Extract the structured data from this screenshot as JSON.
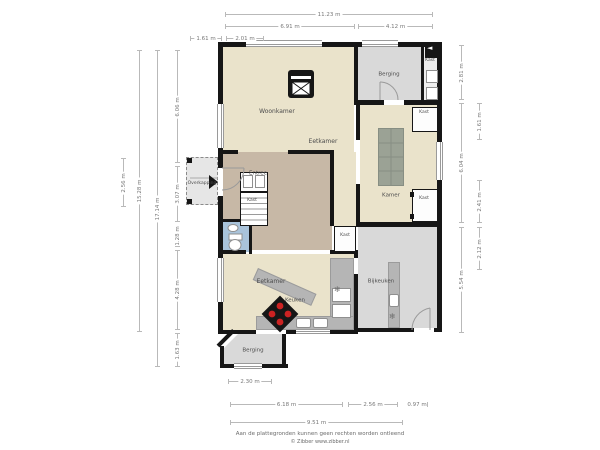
{
  "plan": {
    "room_labels": [
      {
        "text": "Woonkamer",
        "x": 277,
        "y": 112,
        "fs": 6
      },
      {
        "text": "Eetkamer",
        "x": 323,
        "y": 142,
        "fs": 6
      },
      {
        "text": "Berging",
        "x": 389,
        "y": 75,
        "fs": 5.5
      },
      {
        "text": "Kast",
        "x": 430,
        "y": 61,
        "fs": 4.5
      },
      {
        "text": "Kamer",
        "x": 391,
        "y": 196,
        "fs": 5.5
      },
      {
        "text": "Kast",
        "x": 424,
        "y": 113,
        "fs": 4.5
      },
      {
        "text": "Kast",
        "x": 424,
        "y": 199,
        "fs": 4.5
      },
      {
        "text": "Entree",
        "x": 258,
        "y": 174,
        "fs": 5.5
      },
      {
        "text": "Kast",
        "x": 252,
        "y": 201,
        "fs": 4.5
      },
      {
        "text": "Overkapping",
        "x": 202,
        "y": 184,
        "fs": 4.5
      },
      {
        "text": "Kast",
        "x": 345,
        "y": 236,
        "fs": 4.5
      },
      {
        "text": "Eetkamer",
        "x": 271,
        "y": 282,
        "fs": 6
      },
      {
        "text": "Keuken",
        "x": 295,
        "y": 301,
        "fs": 5.5
      },
      {
        "text": "Bijkeuken",
        "x": 381,
        "y": 282,
        "fs": 5.5
      },
      {
        "text": "Berging",
        "x": 253,
        "y": 351,
        "fs": 5.5
      }
    ],
    "dimensions": {
      "h": [
        {
          "t": "11.23 m",
          "x1": 225,
          "x2": 433,
          "y": 14
        },
        {
          "t": "6.91 m",
          "x1": 225,
          "x2": 355,
          "y": 26
        },
        {
          "t": "4.12 m",
          "x1": 358,
          "x2": 433,
          "y": 26
        },
        {
          "t": "1.61 m",
          "x1": 190,
          "x2": 222,
          "y": 38
        },
        {
          "t": "2.01 m",
          "x1": 226,
          "x2": 264,
          "y": 38
        },
        {
          "t": "2.30 m",
          "x1": 228,
          "x2": 272,
          "y": 381
        },
        {
          "t": "6.18 m",
          "x1": 230,
          "x2": 343,
          "y": 404
        },
        {
          "t": "2.56 m",
          "x1": 348,
          "x2": 398,
          "y": 404
        },
        {
          "t": "0.97 m",
          "x1": 406,
          "x2": 428,
          "y": 404
        },
        {
          "t": "9.51 m",
          "x1": 230,
          "x2": 403,
          "y": 422
        }
      ],
      "v": [
        {
          "t": "2.56 m",
          "x": 123,
          "y1": 158,
          "y2": 207
        },
        {
          "t": "15.28 m",
          "x": 139,
          "y1": 50,
          "y2": 332
        },
        {
          "t": "17.14 m",
          "x": 157,
          "y1": 50,
          "y2": 367
        },
        {
          "t": "6.06 m",
          "x": 177,
          "y1": 50,
          "y2": 163
        },
        {
          "t": "3.07 m",
          "x": 177,
          "y1": 166,
          "y2": 222
        },
        {
          "t": "1.28 m",
          "x": 177,
          "y1": 225,
          "y2": 247
        },
        {
          "t": "4.28 m",
          "x": 177,
          "y1": 250,
          "y2": 330
        },
        {
          "t": "1.63 m",
          "x": 177,
          "y1": 333,
          "y2": 367
        },
        {
          "t": "2.81 m",
          "x": 461,
          "y1": 45,
          "y2": 100
        },
        {
          "t": "6.04 m",
          "x": 461,
          "y1": 103,
          "y2": 223
        },
        {
          "t": "5.54 m",
          "x": 461,
          "y1": 227,
          "y2": 333
        },
        {
          "t": "1.61 m",
          "x": 479,
          "y1": 103,
          "y2": 140
        },
        {
          "t": "2.41 m",
          "x": 479,
          "y1": 180,
          "y2": 223
        },
        {
          "t": "2.12 m",
          "x": 479,
          "y1": 227,
          "y2": 270
        }
      ]
    },
    "icons": {
      "snowflake": "❄",
      "entry_arrow_left": "◄"
    },
    "colors": {
      "room_beige": "#eae3cb",
      "room_tan": "#c7b8a6",
      "room_gray": "#d9d9d9",
      "room_gray_light": "#ededed",
      "toilet_blue": "#a9c3da",
      "wall": "#161616",
      "counter": "#b5b5b5",
      "table": "#9ba295",
      "stove_burner": "#cc2222"
    },
    "footer": {
      "line1": "Aan de plattegronden kunnen geen rechten worden ontleend",
      "line2": "© Zibber www.zibber.nl"
    }
  }
}
